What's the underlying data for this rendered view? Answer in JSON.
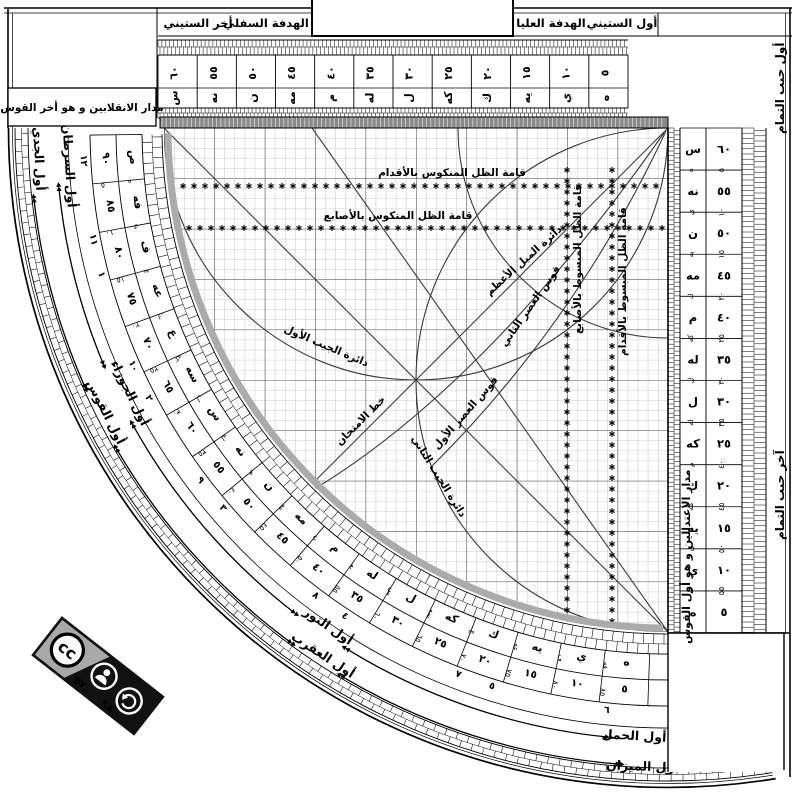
{
  "top": {
    "labels": {
      "first_sixty": "أول الستيني",
      "upper_sight": "الهدفة العليا",
      "lower_sight": "الهدفة السفلي",
      "last_sixty": "أخر الستيني"
    },
    "scale": {
      "numbers_rtl": [
        "٥",
        "١٠",
        "١٥",
        "٢٠",
        "٢٥",
        "٣٠",
        "٣٥",
        "٤٠",
        "٤٥",
        "٥٠",
        "٥٥",
        "٦٠"
      ],
      "abjad_rtl": [
        "ه",
        "ي",
        "يه",
        "ك",
        "كه",
        "ل",
        "له",
        "م",
        "مه",
        "ن",
        "نه",
        "س"
      ]
    }
  },
  "left_box": {
    "label": "مدار الانقلابين و هو أخر القوس"
  },
  "corner_box": {
    "label": "مدار الاعتدالين و هو أول القوس"
  },
  "right_scale": {
    "top_label": "أول جيب التمام",
    "bottom_label": "آخر جيب التمام",
    "letters": [
      "س",
      "نه",
      "ن",
      "مه",
      "م",
      "له",
      "ل",
      "كه",
      "ك",
      "يه",
      "ي",
      "ه"
    ],
    "numbers": [
      "٦٠",
      "٥٥",
      "٥٠",
      "٤٥",
      "٤٠",
      "٣٥",
      "٣٠",
      "٢٥",
      "٢٠",
      "١٥",
      "١٠",
      "٥"
    ],
    "alt_numbers": [
      "٥",
      "١٠",
      "١٥",
      "٢٠",
      "٢٥",
      "٣٠",
      "٣٥",
      "٤٠",
      "٤٥",
      "٥٠",
      "٥٥"
    ],
    "alt_letters": [
      "ه",
      "ي",
      "يه",
      "ك",
      "كه",
      "ل",
      "له",
      "م",
      "مه",
      "ن",
      "نه"
    ]
  },
  "arc_scale": {
    "letters": [
      "ص",
      "فه",
      "ف",
      "عه",
      "ع",
      "سه",
      "س",
      "نه",
      "ن",
      "مه",
      "م",
      "له",
      "ل",
      "كه",
      "ك",
      "يه",
      "ي",
      "ه"
    ],
    "numbers": [
      "٩٠",
      "٨٥",
      "٨٠",
      "٧٥",
      "٧٠",
      "٦٥",
      "٦٠",
      "٥٥",
      "٥٠",
      "٤٥",
      "٤٠",
      "٣٥",
      "٣٠",
      "٢٥",
      "٢٠",
      "١٥",
      "١٠",
      "٥"
    ],
    "alt_numbers": [
      "٥",
      "١٠",
      "١٥",
      "٢٠",
      "٢٥",
      "٣٠",
      "٣٥",
      "٤٠",
      "٤٥",
      "٥٠",
      "٥٥",
      "٦٠",
      "٦٥",
      "٧٠",
      "٧٥",
      "٨٠",
      "٨٥"
    ],
    "alt_letters": [
      "ه",
      "ي",
      "يه",
      "ك",
      "كه",
      "ل",
      "له",
      "م",
      "مه",
      "ن",
      "نه",
      "س",
      "سه",
      "ع",
      "عه",
      "ف",
      "فه"
    ],
    "hours": [
      "١٢",
      "١١",
      "١",
      "١٠",
      "٢",
      "٩",
      "٣",
      "٨",
      "٤",
      "٧",
      "٥",
      "٦"
    ]
  },
  "zodiac": {
    "jady": "أول الجدي",
    "saratan": "أول السرطان",
    "jawza": "أول الجوزاء",
    "qaws": "أول القوس",
    "thawr": "أول الثور",
    "aqrab": "أول العقرب",
    "hamal": "أول الحمل",
    "mizan": "أول الميزان"
  },
  "grid_labels": {
    "mankus_aqdam": "قامة الظل المنكوس بالأقدام",
    "mankus_asabi": "قامة الظل المنكوس بالأصابع",
    "mabsut_asabi": "قامة الظل المبسوط بالأصابع",
    "mabsut_aqdam": "قامة الظل المبسوط بالأقدام",
    "mayl": "دائرة الميل الأعظم",
    "asr2": "قوس العصر الثاني",
    "asr1": "قوس العصر الأول",
    "jayb1": "دائرة الجيب الأول",
    "jayb2": "دائرة الجيب الثاني",
    "imtihan": "خط الامتحان"
  },
  "badge": {
    "cc": "cc",
    "by": "BY",
    "sa": "SA"
  },
  "colors": {
    "ink": "#1a1a1a",
    "gray_bar": "#8a8a8a",
    "crescent": "#ababab",
    "badge_gray": "#a8a8a8",
    "badge_black": "#111111"
  }
}
